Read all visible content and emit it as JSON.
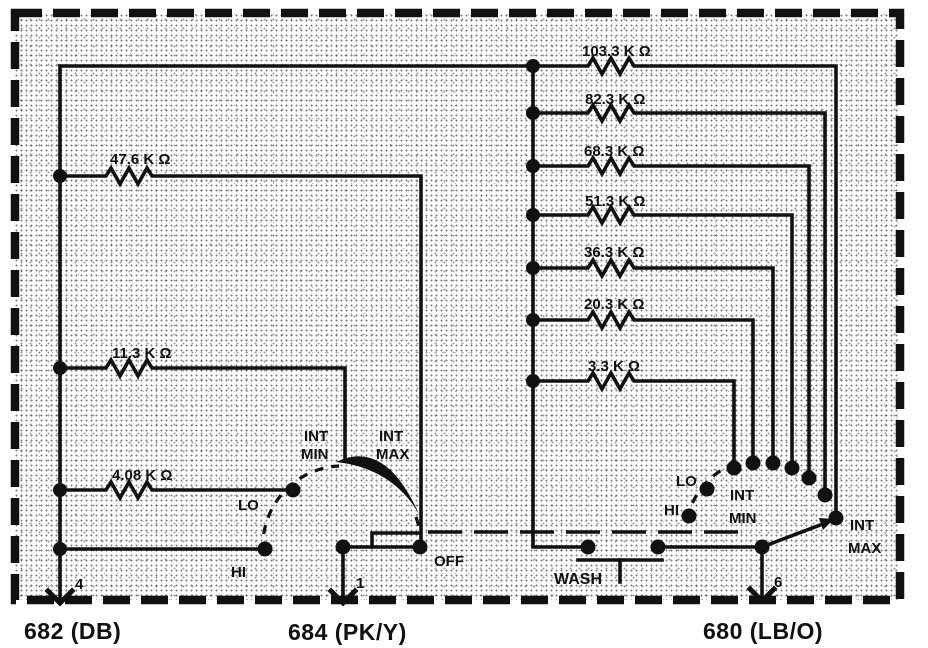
{
  "palette": {
    "ink": "#111111",
    "paper": "#ffffff"
  },
  "left_resistor_bank": {
    "resistors": [
      {
        "value": "47.6 K Ω"
      },
      {
        "value": "11.3 K Ω"
      },
      {
        "value": "4.08 K Ω"
      }
    ]
  },
  "right_resistor_bank": {
    "resistors": [
      {
        "value": "103.3 K Ω"
      },
      {
        "value": "82.3 K Ω"
      },
      {
        "value": "68.3 K Ω"
      },
      {
        "value": "51.3 K Ω"
      },
      {
        "value": "36.3 K Ω"
      },
      {
        "value": "20.3 K Ω"
      },
      {
        "value": "3.3 K Ω"
      }
    ]
  },
  "left_switch": {
    "positions": {
      "lo": "LO",
      "hi": "HI",
      "int": "INT",
      "min": "MIN",
      "max": "MAX",
      "off": "OFF"
    }
  },
  "right_switch": {
    "positions": {
      "lo": "LO",
      "hi": "HI",
      "int": "INT",
      "min": "MIN",
      "max": "MAX"
    },
    "wash_label": "WASH"
  },
  "terminals": [
    {
      "pin": "4",
      "connector": "682 (DB)"
    },
    {
      "pin": "1",
      "connector": "684 (PK/Y)"
    },
    {
      "pin": "6",
      "connector": "680 (LB/O)"
    }
  ]
}
